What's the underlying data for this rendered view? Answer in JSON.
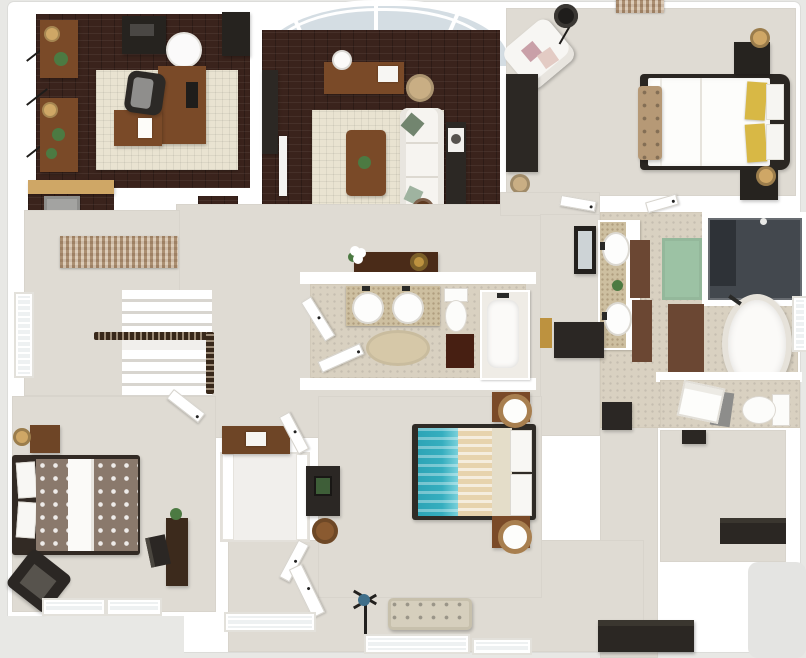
{
  "meta": {
    "title": "3D rendered apartment floor plan (top-down dollhouse view)",
    "canvas_width": 806,
    "canvas_height": 658,
    "visible_text": "none"
  },
  "palette": {
    "outside": "#e8e8e5",
    "slab": "#ffffff",
    "woodFloor": "#3a231c",
    "rugCream": "#e9e3d1",
    "carpet": "#dfdbd3",
    "carpetDim": "#d7d3ca",
    "tile": "#d9d1c1",
    "counterSpeckle": "#cdbfa0",
    "wood": "#7a4a28",
    "woodDark": "#5e3a20",
    "woodDresser": "#6e4526",
    "furnBlack": "#2b2723",
    "glass": "#d4dde3",
    "showerGlass": "#43484e",
    "matBrown": "#5e3726",
    "matGreen": "#9cc2a4",
    "teal": "#35aebf",
    "tanStripe": "#e7d3ad",
    "blanket": "#e4ddc9",
    "yellow": "#d8b845",
    "pink": "#c9a0a8",
    "sage": "#72856f",
    "benchTan": "#d6cfbd",
    "tuftTan": "#b69976",
    "lampTan": "#cfa766",
    "plant": "#4c7a42",
    "patternTaupe": "#8a796c",
    "weaveTan": "#cdb69a",
    "railDark": "#38281a",
    "appliance": "#a3a3a1",
    "grayPatch": "#e4e4e2",
    "towelGray": "#8d8d8b",
    "gold": "#bd923f",
    "mirror": "#cdd3d6"
  },
  "rooms": [
    {
      "id": "study",
      "floor": "dark-brick",
      "furniture": [
        "l-shaped-desk",
        "office-chair",
        "monitor",
        "printer-cabinet",
        "speaker-cabinet",
        "round-ottoman",
        "wall-shelf-upper",
        "wall-shelf-lower",
        "shelf-lamps",
        "potted-plants",
        "cream-area-rug",
        "laundry-counter",
        "appliance"
      ]
    },
    {
      "id": "living-room",
      "floor": "dark-brick",
      "furniture": [
        "bow-window",
        "window-console-table",
        "orb-table-lamp",
        "basket-pouf",
        "media-console",
        "tv-panel",
        "cream-area-rug",
        "coffee-table",
        "white-sofa",
        "sofa-back-table",
        "speaker",
        "round-side-table",
        "loft-railing"
      ]
    },
    {
      "id": "master-bedroom",
      "floor": "carpet",
      "furniture": [
        "bed-yellow-pillows",
        "upholstered-foot-bench",
        "nightstand-left",
        "nightstand-right",
        "table-lamps",
        "white-armchair",
        "accent-pillows",
        "arc-floor-lamp",
        "dresser",
        "basket",
        "wall-tapestry"
      ]
    },
    {
      "id": "master-bathroom",
      "floor": "beige-tile",
      "furniture": [
        "double-vanity",
        "oval-sinks",
        "runner-rugs",
        "green-bath-mat",
        "brown-bath-mat",
        "walk-in-shower",
        "freestanding-tub",
        "tub-faucet",
        "water-closet-toilet",
        "towel-pile",
        "side-chair",
        "window"
      ]
    },
    {
      "id": "hall-bathroom",
      "floor": "beige-tile",
      "furniture": [
        "double-vanity",
        "round-sinks",
        "toilet",
        "bathtub",
        "dark-bath-mat",
        "round-rug",
        "doors",
        "hall-console-table",
        "flower-vase",
        "gold-bowl"
      ]
    },
    {
      "id": "hallway-stairs",
      "floor": "carpet",
      "furniture": [
        "woven-runner-rug",
        "staircase",
        "stair-railing",
        "window",
        "leaning-mirror",
        "hamper",
        "gold-towel",
        "hall-bench"
      ]
    },
    {
      "id": "bedroom-left",
      "floor": "carpet",
      "furniture": [
        "bed-tree-pattern-duvet",
        "nightstand",
        "table-lamp",
        "accent-chair",
        "writing-desk",
        "desk-chair",
        "desk-plant",
        "windows"
      ]
    },
    {
      "id": "bedroom-middle",
      "floor": "carpet",
      "furniture": [
        "bed-teal-striped-duvet",
        "nightstand-top",
        "nightstand-bottom",
        "orb-lamps",
        "dresser-desk",
        "round-stool",
        "closet-doors"
      ]
    },
    {
      "id": "walk-in-closet",
      "floor": "white",
      "furniture": [
        "shelving",
        "dresser",
        "radio"
      ]
    },
    {
      "id": "foyer",
      "floor": "carpet",
      "furniture": [
        "tufted-bench",
        "coat-sculpture",
        "entry-door",
        "windows",
        "storage-bench-a",
        "storage-bench-b",
        "closet-rods",
        "garage-pad"
      ]
    }
  ]
}
